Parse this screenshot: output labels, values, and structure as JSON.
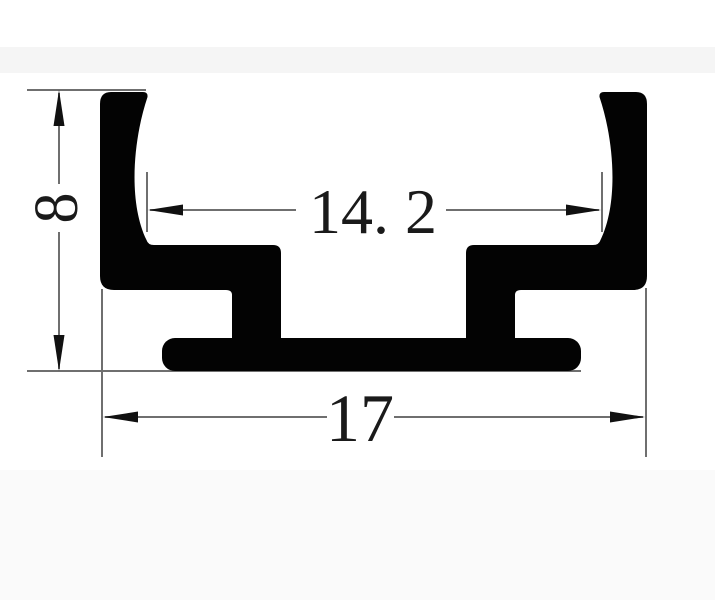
{
  "drawing": {
    "dimensions": {
      "height": {
        "value": "8",
        "orientation": "vertical"
      },
      "opening_width": {
        "value": "14. 2",
        "orientation": "horizontal"
      },
      "overall_width": {
        "value": "17",
        "orientation": "horizontal"
      }
    },
    "colors": {
      "background": "#ffffff",
      "profile": "#030303",
      "line": "#6f6f6f",
      "arrow": "#111111",
      "text": "#1a1a1a",
      "band_top": "#f5f5f5",
      "band_bottom": "#fafafa"
    }
  }
}
